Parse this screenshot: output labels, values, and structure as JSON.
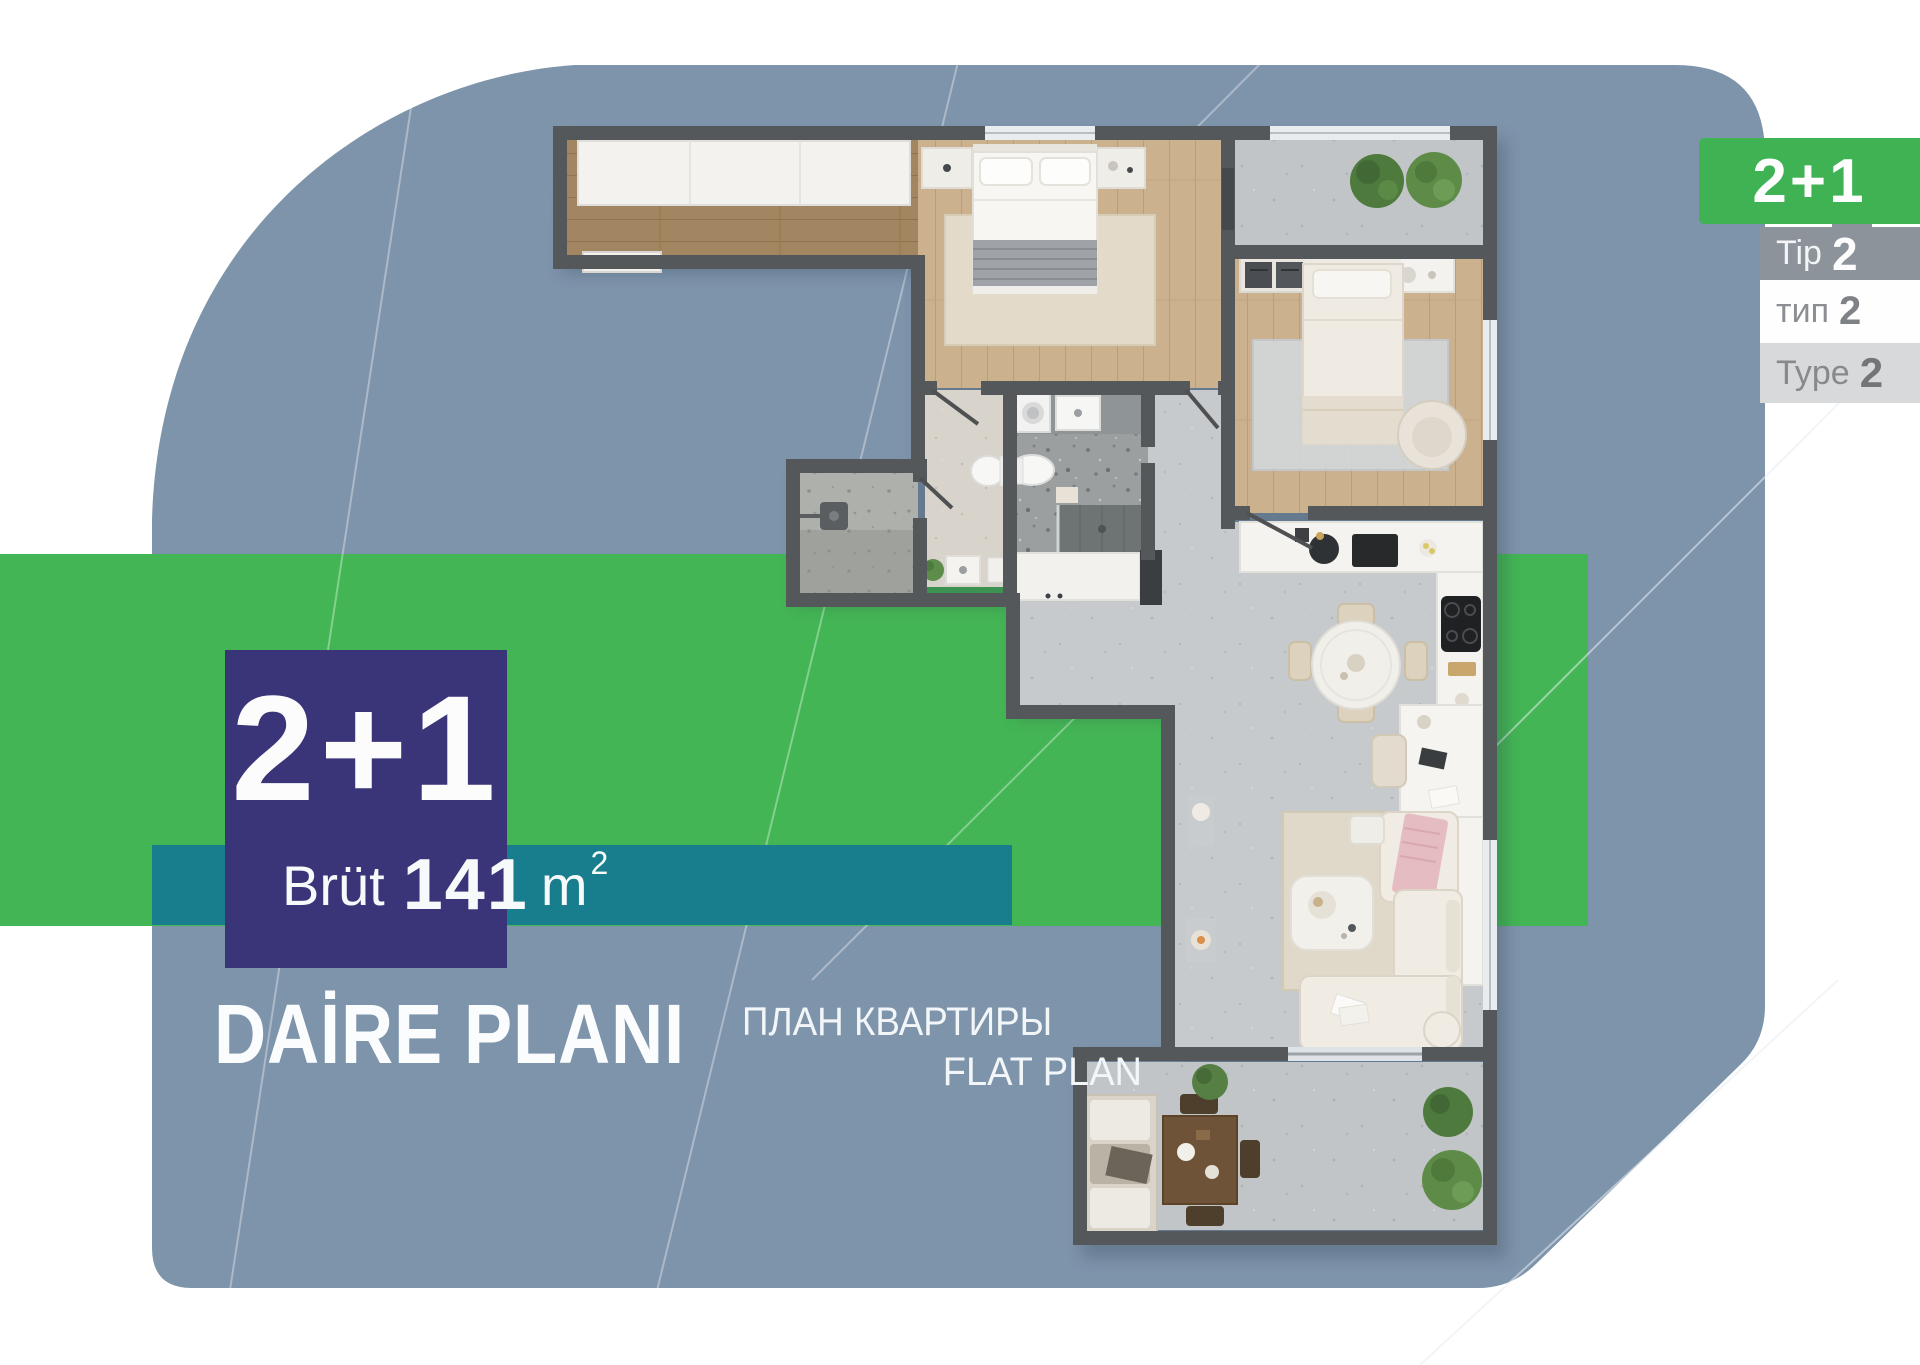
{
  "poster": {
    "area_box": {
      "bedrooms": "2+1"
    },
    "area_band": {
      "label": "Brüt",
      "value": "141",
      "unit": "m",
      "sup": "2"
    },
    "titles": {
      "tr": "DAİRE PLANI",
      "ru": "ПЛАН КВАРТИРЫ",
      "en": "FLAT PLAN"
    },
    "corner": {
      "badge": "2+1",
      "rows": [
        {
          "label": "Tip",
          "value": "2"
        },
        {
          "label": "тип",
          "value": "2"
        },
        {
          "label": "Type",
          "value": "2"
        }
      ]
    },
    "colors": {
      "slate": "#7E94AB",
      "green": "#43B554",
      "teal": "#187E8E",
      "navy": "#3A3478",
      "wall": "#55585A",
      "wood": "#CBB18E",
      "concrete": "#C7CACC"
    }
  }
}
